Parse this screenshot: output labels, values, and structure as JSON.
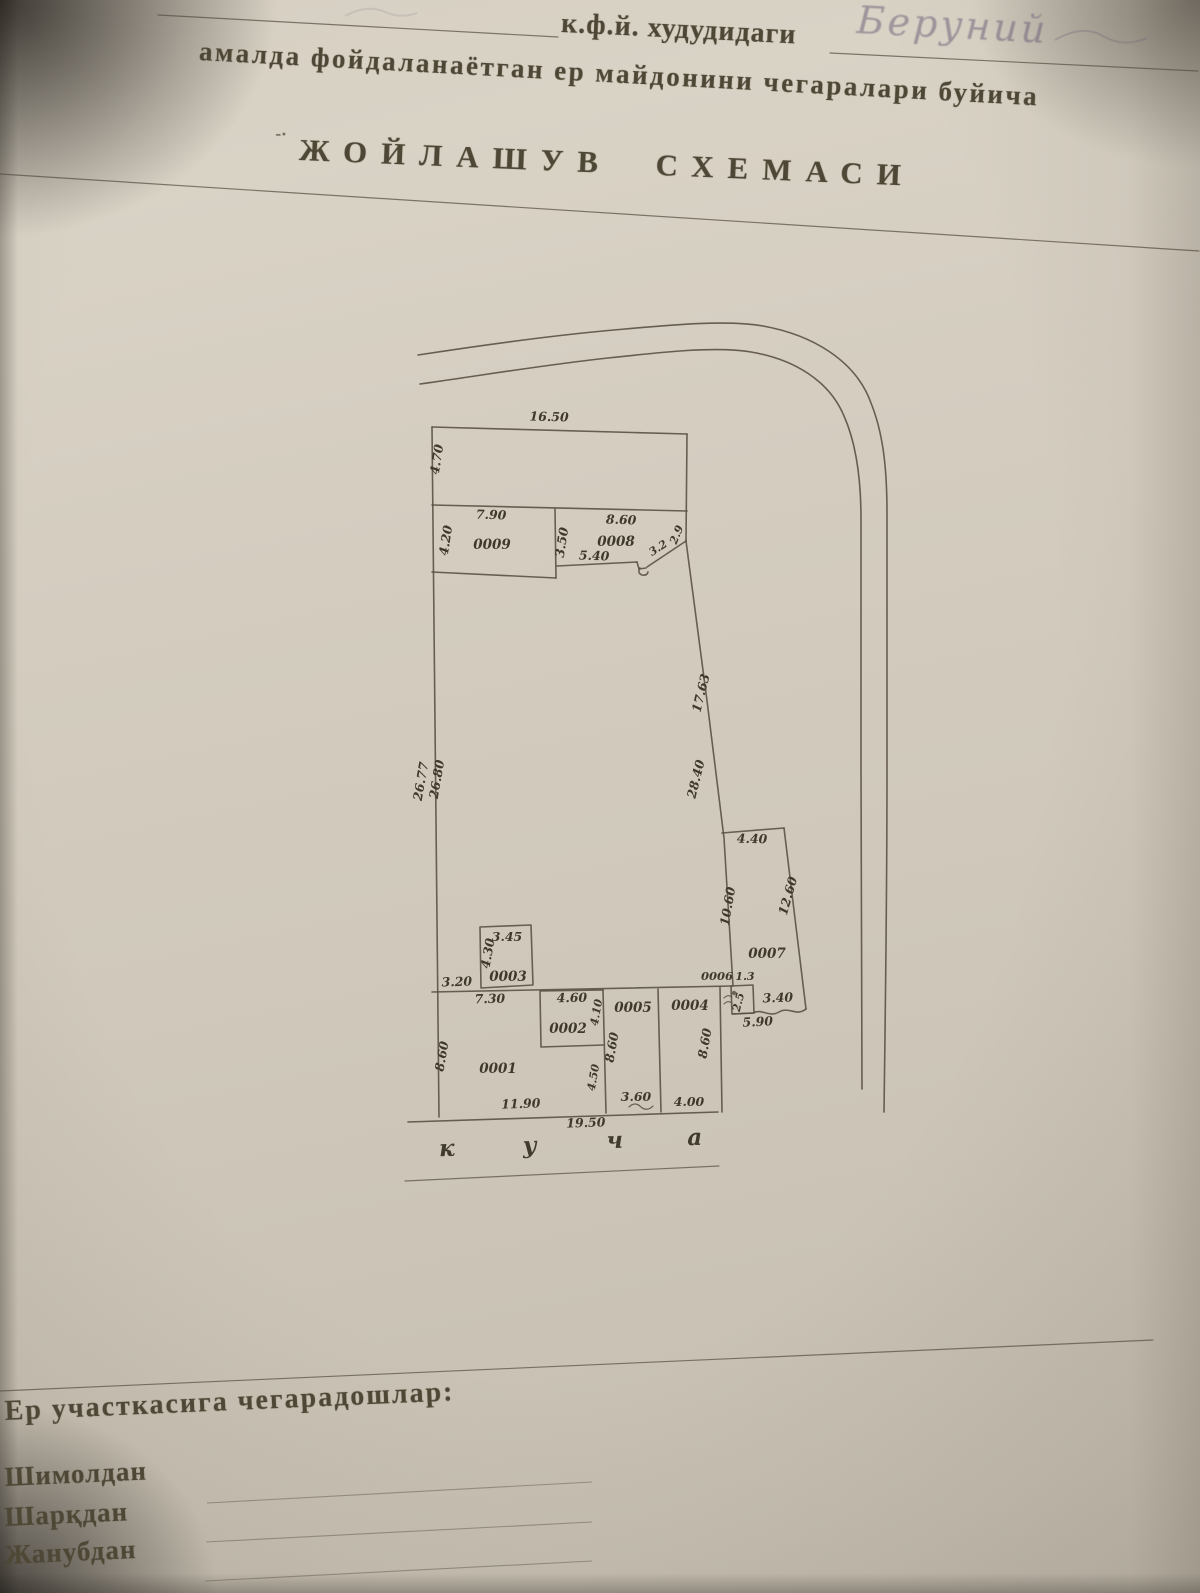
{
  "header": {
    "form_line1": "к.ф.й. худудидаги",
    "handwritten_entry": "Беруний",
    "form_line2": "амалда фойдаланаётган ер майдонини чегаралари буйича",
    "dash_mark": "-·",
    "title": "ЖОЙЛАШУВ СХЕМАСИ"
  },
  "diagram": {
    "parcels": {
      "p0001": "0001",
      "p0002": "0002",
      "p0003": "0003",
      "p0004": "0004",
      "p0005": "0005",
      "p0006": "0006",
      "p0007": "0007",
      "p0008": "0008",
      "p0009": "0009"
    },
    "dims": {
      "top_width": "16.50",
      "top_strip_height": "4.70",
      "p9_width": "7.90",
      "p9_height": "4.20",
      "p9_p8_gap": "3.50",
      "p8_width": "8.60",
      "p8_bottom": "5.40",
      "p8_diag": "3.2",
      "p8_right": "2.9",
      "right_upper": "17.63",
      "right_lower": "28.40",
      "left_outer": "26.77",
      "left_inner": "26.80",
      "p7_top": "4.40",
      "p7_left": "10.60",
      "p7_right": "12.60",
      "p7_bottom_right": "3.40",
      "p7_bottom_total": "5.90",
      "p6_top": "1.3",
      "p6_side": "2.5",
      "p3_top": "3.45",
      "p3_side": "4.30",
      "p3_offset": "3.20",
      "p1_top": "7.30",
      "p1_left": "8.60",
      "p1_bottom": "11.90",
      "p2_top": "4.60",
      "p2_side": "4.10",
      "p2_below": "4.50",
      "p5_side": "8.60",
      "p5_bottom": "3.60",
      "p4_side": "8.60",
      "p4_bottom": "4.00",
      "bottom_total": "19.50"
    },
    "street_letters": [
      "к",
      "у",
      "ч",
      "а"
    ]
  },
  "footer": {
    "heading": "Ер участкасига чегарадошлар:",
    "boundary_labels": [
      "Шимолдан",
      "Шарқдан",
      "Жанубдан"
    ]
  }
}
